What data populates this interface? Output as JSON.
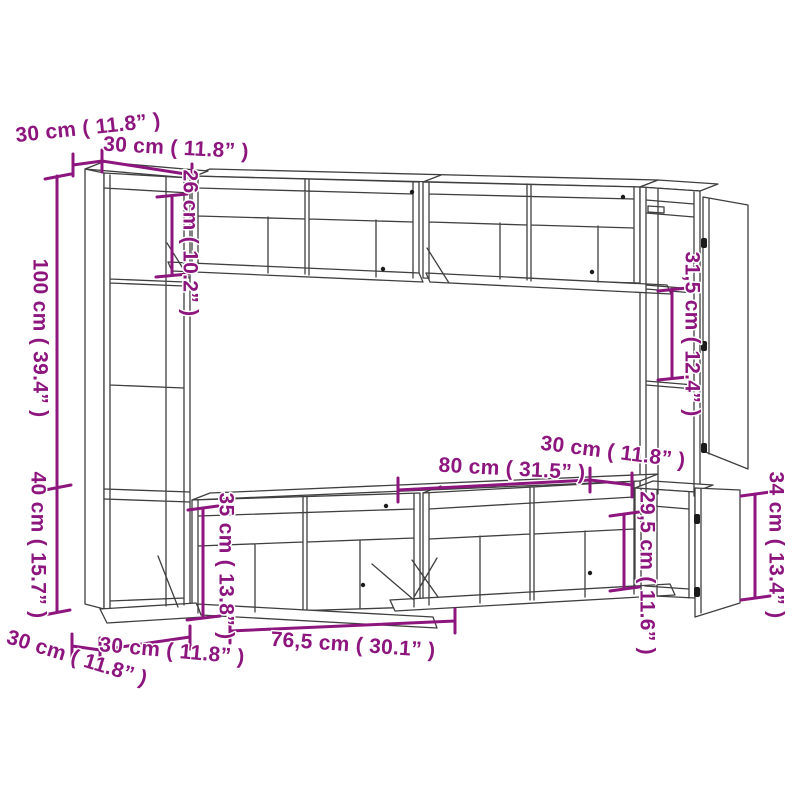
{
  "colors": {
    "dimension_accent": "#8D167E",
    "drawing_lines": "#3F3F3F",
    "background": "#FFFFFF",
    "hardware": "#1B1B1B"
  },
  "dims": {
    "top_depth": "30 cm ( 11.8” )",
    "top_width": "30 cm ( 11.8” )",
    "left_height_upper": "100 cm ( 39.4” )",
    "left_height_lower": "40 cm ( 15.7” )",
    "inner_top_left_height": "26 cm ( 10.2” )",
    "inner_right_height": "31,5 cm ( 12.4” )",
    "right_unit_depth": "30 cm ( 11.8” )",
    "stand_width": "80 cm ( 31.5” )",
    "inner_lower_right_height": "29,5 cm ( 11.6” )",
    "right_cabinet_height": "34 cm ( 13.4” )",
    "inner_lower_left_height": "35 cm ( 13.8” )",
    "bottom_depth": "30 cm ( 11.8” )",
    "bottom_width": "30 cm ( 11.8” )",
    "bottom_stand_width": "76,5 cm ( 30.1” )"
  }
}
